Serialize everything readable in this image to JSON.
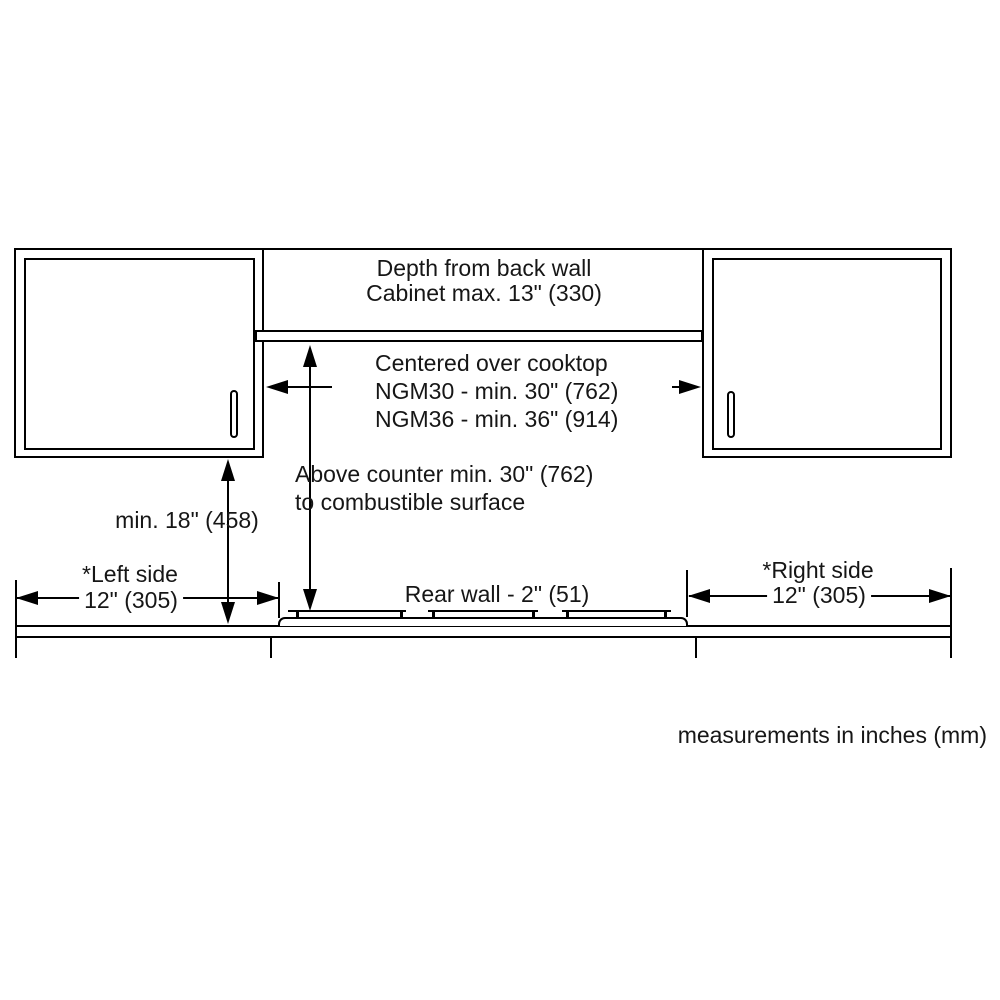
{
  "diagram": {
    "kind": "cooktop-installation-clearance-drawing",
    "labels": {
      "depth_line1": "Depth from back wall",
      "depth_line2": "Cabinet max. 13\" (330)",
      "centered_line1": "Centered over cooktop",
      "centered_line2": "NGM30 - min. 30\" (762)",
      "centered_line3": "NGM36 - min. 36\" (914)",
      "above_counter_line1": "Above counter min. 30\" (762)",
      "above_counter_line2": "to combustible surface",
      "min_height": "min. 18\" (458)",
      "rear_wall": "Rear wall - 2\" (51)",
      "left_side_line1": "*Left side",
      "left_side_line2": "12\" (305)",
      "right_side_line1": "*Right side",
      "right_side_line2": "12\" (305)",
      "units_note": "measurements in inches (mm)"
    },
    "colors": {
      "line": "#000000",
      "text": "#161616",
      "background": "#ffffff"
    }
  }
}
